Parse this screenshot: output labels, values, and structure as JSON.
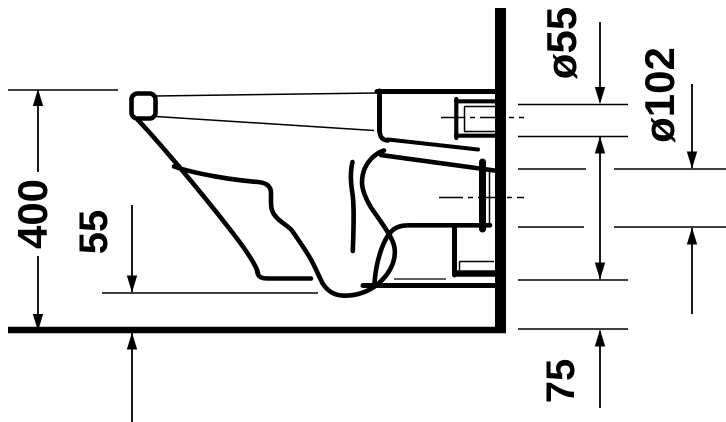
{
  "diagram": {
    "type": "technical-dimension-drawing",
    "subject": "wall-hung toilet, side elevation section",
    "units": "mm",
    "colors": {
      "line": "#000000",
      "background": "#ffffff"
    }
  },
  "dimensions": {
    "overall_height": {
      "label": "400"
    },
    "bowl_underside_to_floor": {
      "label": "55"
    },
    "inlet_pipe_diameter": {
      "label": "ø55"
    },
    "outlet_pipe_diameter": {
      "label": "ø102"
    },
    "outlet_underside_to_floor": {
      "label": "75"
    }
  }
}
